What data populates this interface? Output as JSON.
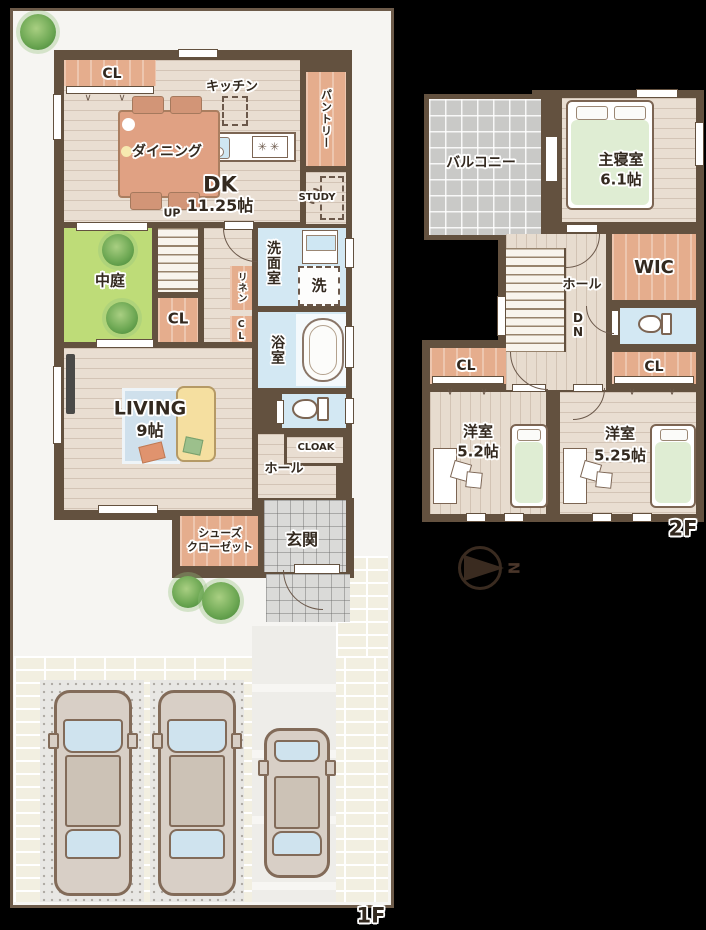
{
  "floor1": {
    "label": "1F",
    "rooms": {
      "cl_top": "CL",
      "kitchen": "キッチン",
      "pantry": "パントリー",
      "dining": "ダイニング",
      "dk": "DK",
      "dk_size": "11.25帖",
      "study": "STUDY",
      "up": "UP",
      "courtyard": "中庭",
      "cl_stair": "CL",
      "linen": "リネン",
      "cl_mid": "CL",
      "washroom": "洗面室",
      "laundry": "洗",
      "bath": "浴室",
      "living": "LIVING",
      "living_size": "9帖",
      "cloak": "CLOAK",
      "hall": "ホール",
      "shoes_line1": "シューズ",
      "shoes_line2": "クローゼット",
      "entrance": "玄関"
    }
  },
  "floor2": {
    "label": "2F",
    "rooms": {
      "balcony": "バルコニー",
      "master": "主寝室",
      "master_size": "6.1帖",
      "hall": "ホール",
      "down_d": "D",
      "down_n": "N",
      "wic": "WIC",
      "cl_left": "CL",
      "cl_right": "CL",
      "west1": "洋室",
      "west1_size": "5.2帖",
      "west2": "洋室",
      "west2_size": "5.25帖"
    }
  },
  "compass": {
    "north": "N"
  },
  "glyphs": {
    "closet_chevron": "∨",
    "burner": "✳"
  },
  "colors": {
    "wall": "#63513f",
    "wood": "#e9ded2",
    "closet": "#e5ad8d",
    "water": "#d3e8f3",
    "courtyard": "#bedc78",
    "balcony_tile": "#c9c9c7",
    "entry_tile": "#dadad8",
    "brick": "#f2efe1",
    "bed": "#dfedd3",
    "lot": "#f6f5f2"
  }
}
